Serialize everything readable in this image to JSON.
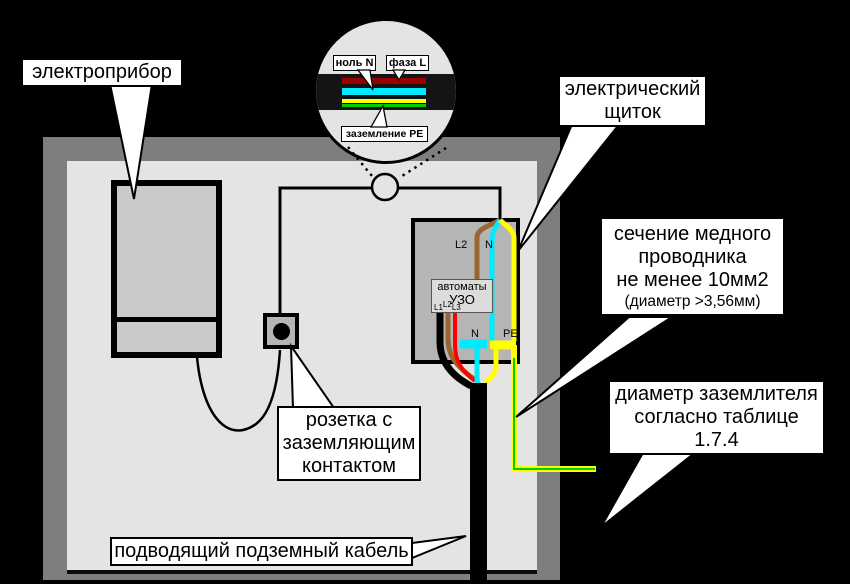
{
  "callouts": {
    "appliance": {
      "text": "электроприбор"
    },
    "panel": {
      "line1": "электрический",
      "line2": "щиток"
    },
    "section": {
      "line1": "сечение медного",
      "line2": "проводника",
      "line3": "не менее 10мм2",
      "line4": "(диаметр >3,56мм)"
    },
    "earth": {
      "line1": "диаметр заземлителя",
      "line2": "согласно таблице",
      "line3": "1.7.4"
    },
    "socket": {
      "line1": "розетка с",
      "line2": "заземляющим",
      "line3": "контактом"
    },
    "cable": {
      "text": "подводящий подземный кабель"
    }
  },
  "inset": {
    "neutral": "ноль N",
    "phase": "фаза L",
    "ground": "заземление PE"
  },
  "panel": {
    "top_l2": "L2",
    "top_n": "N",
    "bottom_n": "N",
    "bottom_pe": "PE",
    "device_line1": "автоматы",
    "device_line2": "УЗО",
    "phase1": "L1",
    "phase2": "L2",
    "phase3": "L3"
  },
  "colors": {
    "wall": "#7e7e7e",
    "interior": "#e4e4e2",
    "panel_fill": "#b5b5b5",
    "phase_brown": "#996633",
    "phase_red": "#ff0000",
    "phase_black": "#000000",
    "neutral_cyan": "#00eaff",
    "pe_yellow": "#ffff00",
    "ground_green": "#00cc00",
    "inset_phase_red": "#9b0000"
  }
}
